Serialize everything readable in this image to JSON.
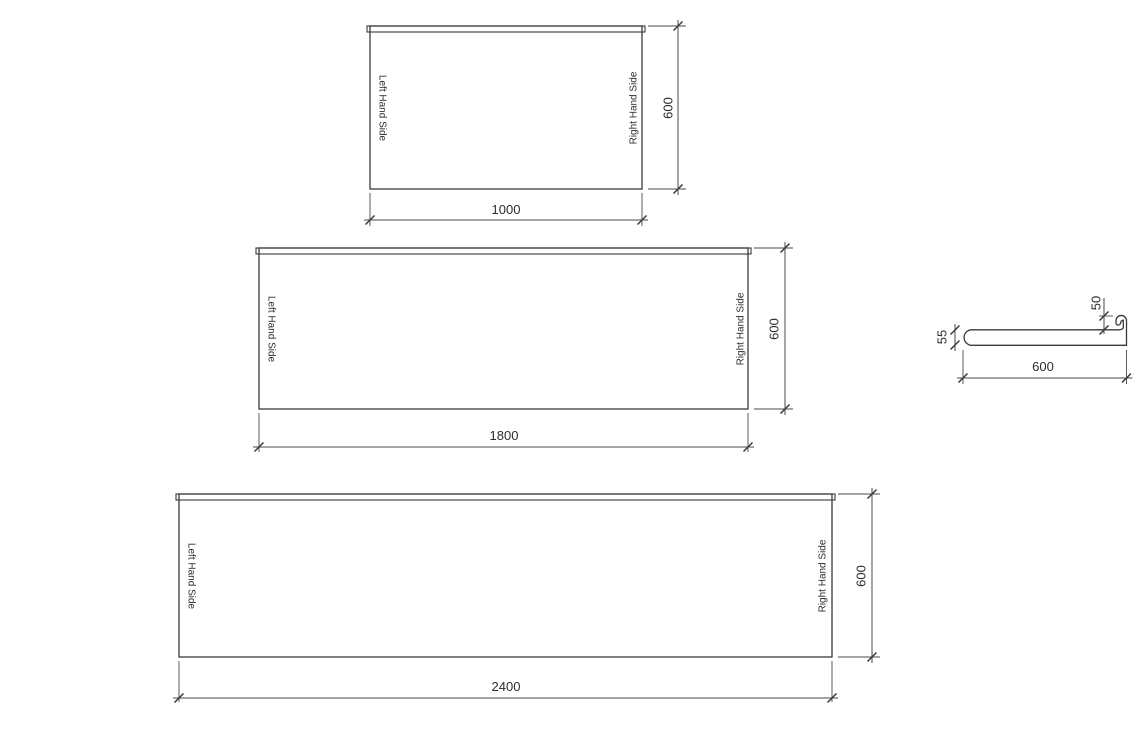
{
  "colors": {
    "background": "#ffffff",
    "line": "#3a3a3a",
    "dimension_line": "#4a4a4a",
    "text": "#2d2d2d"
  },
  "panels": [
    {
      "id": "panel-1000",
      "width_label": "1000",
      "height_label": "600",
      "left_label": "Left Hand Side",
      "right_label": "Right Hand Side"
    },
    {
      "id": "panel-1800",
      "width_label": "1800",
      "height_label": "600",
      "left_label": "Left Hand Side",
      "right_label": "Right Hand Side"
    },
    {
      "id": "panel-2400",
      "width_label": "2400",
      "height_label": "600",
      "left_label": "Left Hand Side",
      "right_label": "Right Hand Side"
    }
  ],
  "profile": {
    "depth_label": "600",
    "lip_label": "50",
    "thickness_label": "55"
  }
}
